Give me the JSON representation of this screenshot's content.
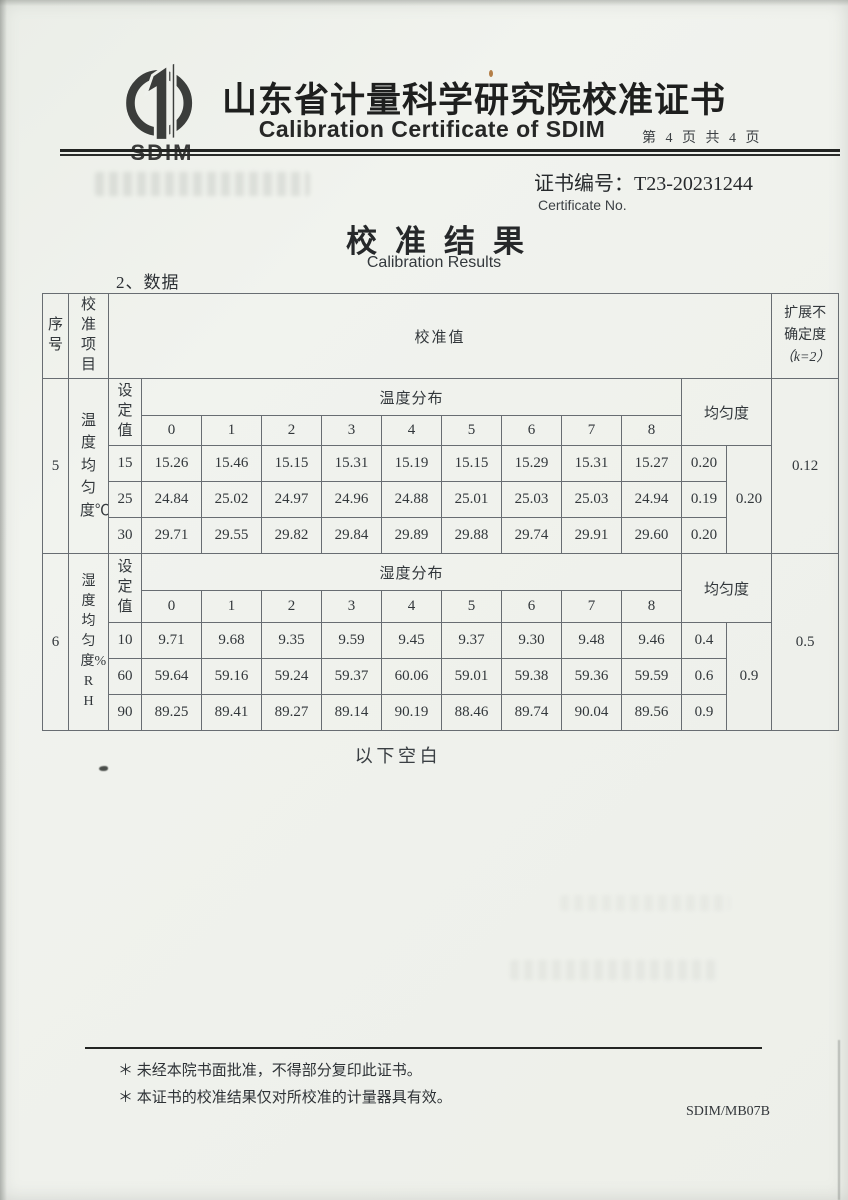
{
  "header": {
    "logo_text": "SDIM",
    "title_cn": "山东省计量科学研究院校准证书",
    "title_en": "Calibration Certificate of SDIM",
    "page_info": "第 4 页 共 4 页"
  },
  "certificate": {
    "number_label": "证书编号：",
    "number": "T23-20231244",
    "number_caption": "Certificate No."
  },
  "results": {
    "title_cn": "校准结果",
    "title_en": "Calibration Results",
    "section_label": "2、数据"
  },
  "table": {
    "headers": {
      "seq": "序号",
      "item": "校准项目",
      "value": "校准值",
      "uncertainty_line1": "扩展不",
      "uncertainty_line2": "确定度",
      "uncertainty_line3": "（k=2）",
      "set_value": "设定值",
      "uniformity": "均匀度"
    },
    "sections": [
      {
        "seq": "5",
        "item": "温度均匀度℃",
        "distribution_label": "温度分布",
        "point_headers": [
          "0",
          "1",
          "2",
          "3",
          "4",
          "5",
          "6",
          "7",
          "8"
        ],
        "rows": [
          {
            "set": "15",
            "values": [
              "15.26",
              "15.46",
              "15.15",
              "15.31",
              "15.19",
              "15.15",
              "15.29",
              "15.31",
              "15.27"
            ],
            "uniformity": "0.20"
          },
          {
            "set": "25",
            "values": [
              "24.84",
              "25.02",
              "24.97",
              "24.96",
              "24.88",
              "25.01",
              "25.03",
              "25.03",
              "24.94"
            ],
            "uniformity": "0.19"
          },
          {
            "set": "30",
            "values": [
              "29.71",
              "29.55",
              "29.82",
              "29.84",
              "29.89",
              "29.88",
              "29.74",
              "29.91",
              "29.60"
            ],
            "uniformity": "0.20"
          }
        ],
        "overall_uniformity": "0.20",
        "expanded_uncertainty": "0.12"
      },
      {
        "seq": "6",
        "item": "湿度均匀度%RH",
        "distribution_label": "湿度分布",
        "point_headers": [
          "0",
          "1",
          "2",
          "3",
          "4",
          "5",
          "6",
          "7",
          "8"
        ],
        "rows": [
          {
            "set": "10",
            "values": [
              "9.71",
              "9.68",
              "9.35",
              "9.59",
              "9.45",
              "9.37",
              "9.30",
              "9.48",
              "9.46"
            ],
            "uniformity": "0.4"
          },
          {
            "set": "60",
            "values": [
              "59.64",
              "59.16",
              "59.24",
              "59.37",
              "60.06",
              "59.01",
              "59.38",
              "59.36",
              "59.59"
            ],
            "uniformity": "0.6"
          },
          {
            "set": "90",
            "values": [
              "89.25",
              "89.41",
              "89.27",
              "89.14",
              "90.19",
              "88.46",
              "89.74",
              "90.04",
              "89.56"
            ],
            "uniformity": "0.9"
          }
        ],
        "overall_uniformity": "0.9",
        "expanded_uncertainty": "0.5"
      }
    ]
  },
  "body": {
    "end_note": "以下空白"
  },
  "footer": {
    "note1": "＊ 未经本院书面批准，不得部分复印此证书。",
    "note2": "＊ 本证书的校准结果仅对所校准的计量器具有效。",
    "form_code": "SDIM/MB07B"
  }
}
